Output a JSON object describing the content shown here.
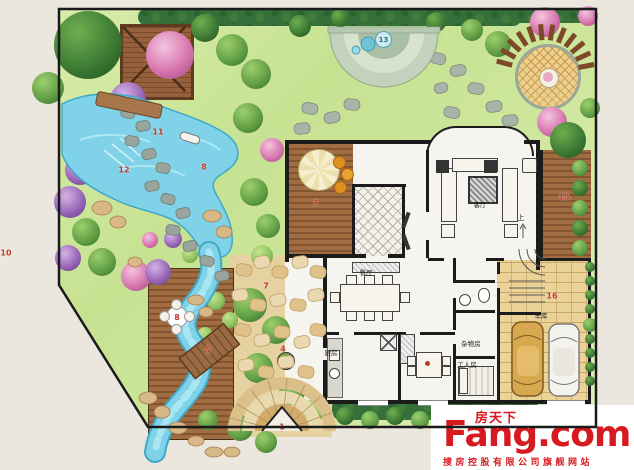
{
  "plan": {
    "markers": {
      "gate": "1",
      "house_deck": "3",
      "planter": "4",
      "bridge": "5",
      "plaza": "7",
      "pond_fall": "8",
      "deck_table": "8",
      "left_edge": "10",
      "pond_path": "11",
      "pond_plants": "12",
      "spa_terrace": "13",
      "east_deck": "15",
      "garage": "16"
    },
    "rooms": {
      "living": "客厅",
      "dining": "餐厅",
      "kitchen": "厨房",
      "garage": "车库",
      "storage": "杂物房",
      "maid": "工人房",
      "stair_up": "上"
    }
  },
  "watermark": {
    "brand_cn": "房天下",
    "brand_en": "Fang.com",
    "tagline": "搜房控股有限公司旗舰网站"
  },
  "colors": {
    "marker_red": "#c03a2a",
    "watermark_red": "#d71920",
    "water": "#7fd2e8",
    "lawn": "#cbe598",
    "wood": "#9a6a40"
  }
}
